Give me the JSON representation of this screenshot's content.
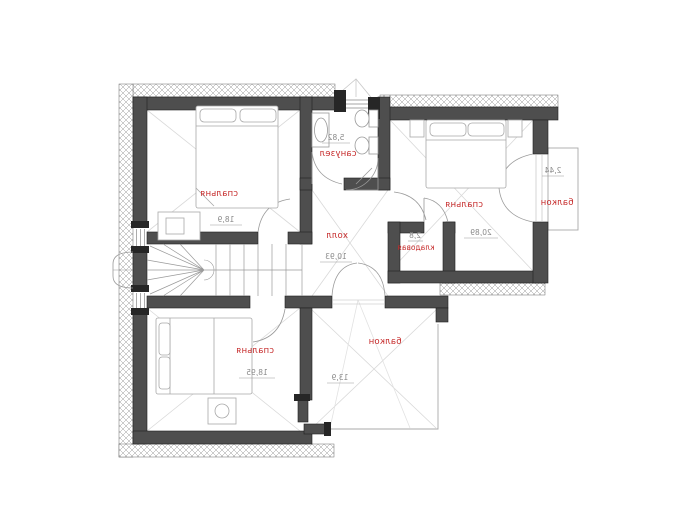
{
  "plan": {
    "type": "floor-plan",
    "text_mirrored": true,
    "rooms": [
      {
        "id": "bedroom-top-left",
        "label": "спальня",
        "area": "18,9"
      },
      {
        "id": "bathroom",
        "label": "санузел",
        "area": "5,82"
      },
      {
        "id": "bedroom-top-right",
        "label": "спальня",
        "area": "20,89"
      },
      {
        "id": "balcony-right",
        "label": "балкон",
        "area": "2,44"
      },
      {
        "id": "storage",
        "label": "кладовая",
        "area": "2,8"
      },
      {
        "id": "hall",
        "label": "холл",
        "area": "10,93"
      },
      {
        "id": "bedroom-bottom-left",
        "label": "спальня",
        "area": "18,95"
      },
      {
        "id": "balcony-bottom",
        "label": "балкон",
        "area": "13,9"
      }
    ],
    "colors": {
      "room_label": "#c62b2b",
      "area_number": "#8a8a8a",
      "wall": "#4e4e4e",
      "thin_line": "#9a9a9a"
    }
  }
}
